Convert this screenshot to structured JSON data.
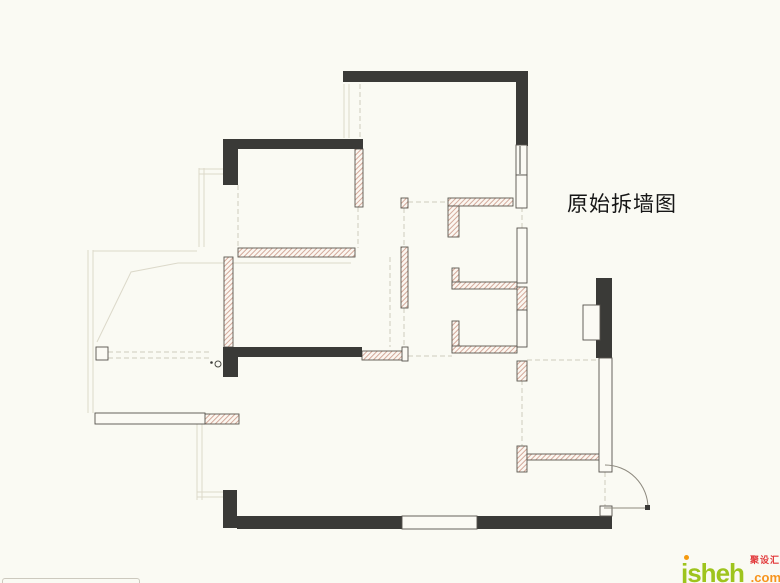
{
  "title": {
    "text": "原始拆墙图"
  },
  "watermark": {
    "brand": "jsheh",
    "tld": ".com",
    "cn": "聚设汇"
  },
  "colors": {
    "background": "#fafaf3",
    "structural_wall": "#3a3a37",
    "hatch_line": "#d4a99a",
    "wall_outline": "#55524c",
    "faint_line": "#dcd9ca",
    "brand_green": "#9ec41d",
    "brand_orange": "#f7941d",
    "brand_red": "#e23a3c"
  },
  "plan": {
    "black_walls": [
      [
        343,
        71,
        185,
        11
      ],
      [
        516,
        82,
        12,
        64
      ],
      [
        223,
        139,
        140,
        10
      ],
      [
        223,
        149,
        15,
        36
      ],
      [
        223,
        347,
        139,
        10
      ],
      [
        223,
        347,
        15,
        30
      ],
      [
        223,
        490,
        14,
        38
      ],
      [
        237,
        516,
        165,
        13
      ],
      [
        477,
        516,
        135,
        13
      ],
      [
        596,
        278,
        16,
        80
      ]
    ],
    "hatched_walls": [
      [
        355,
        149,
        8,
        58
      ],
      [
        238,
        248,
        117,
        9
      ],
      [
        224,
        257,
        9,
        90
      ],
      [
        401,
        198,
        7,
        10
      ],
      [
        401,
        247,
        7,
        61
      ],
      [
        448,
        198,
        65,
        8
      ],
      [
        448,
        206,
        11,
        31
      ],
      [
        452,
        268,
        7,
        21
      ],
      [
        452,
        282,
        65,
        7
      ],
      [
        452,
        321,
        7,
        31
      ],
      [
        452,
        346,
        65,
        7
      ],
      [
        517,
        287,
        10,
        24
      ],
      [
        517,
        361,
        10,
        20
      ],
      [
        517,
        446,
        10,
        26
      ],
      [
        527,
        454,
        73,
        6
      ],
      [
        204,
        414,
        35,
        10
      ],
      [
        362,
        351,
        41,
        9
      ]
    ],
    "white_walls": [
      [
        516,
        145,
        11,
        30
      ],
      [
        516,
        175,
        11,
        33
      ],
      [
        517,
        228,
        10,
        55
      ],
      [
        517,
        310,
        10,
        37
      ],
      [
        599,
        358,
        13,
        114
      ],
      [
        583,
        305,
        17,
        35
      ],
      [
        96,
        347,
        12,
        13
      ],
      [
        95,
        413,
        110,
        11
      ],
      [
        402,
        516,
        75,
        13
      ],
      [
        402,
        347,
        6,
        14
      ],
      [
        600,
        506,
        12,
        10
      ]
    ],
    "solid_faint_lines": [
      [
        88,
        250,
        88,
        413
      ],
      [
        93,
        250,
        93,
        413
      ],
      [
        93,
        251,
        197,
        251
      ],
      [
        344,
        84,
        344,
        138
      ],
      [
        349,
        84,
        349,
        138
      ],
      [
        199,
        168,
        199,
        247
      ],
      [
        204,
        168,
        204,
        247
      ],
      [
        199,
        169,
        223,
        169
      ],
      [
        199,
        174,
        223,
        174
      ],
      [
        197,
        424,
        197,
        500
      ],
      [
        202,
        424,
        202,
        500
      ],
      [
        197,
        492,
        223,
        492
      ],
      [
        197,
        497,
        223,
        497
      ]
    ],
    "dashed_lines": [
      [
        360,
        84,
        360,
        138
      ],
      [
        238,
        185,
        238,
        248
      ],
      [
        358,
        207,
        358,
        248
      ],
      [
        404,
        208,
        404,
        247
      ],
      [
        404,
        308,
        404,
        347
      ],
      [
        522,
        207,
        522,
        228
      ],
      [
        522,
        380,
        522,
        446
      ],
      [
        605,
        472,
        605,
        506
      ],
      [
        390,
        257,
        390,
        347
      ],
      [
        408,
        356,
        452,
        356
      ],
      [
        527,
        360,
        598,
        360
      ],
      [
        408,
        202,
        448,
        202
      ],
      [
        108,
        352,
        210,
        352
      ],
      [
        108,
        358,
        210,
        358
      ]
    ],
    "bay_polyline": "97,342 131,272 178,263 351,263",
    "marks": {
      "window_divider": [
        520,
        146,
        520,
        174
      ],
      "circle": [
        218,
        364,
        3
      ],
      "dot": [
        211.5,
        362.5,
        1.3
      ]
    },
    "door": {
      "leaf": [
        604,
        508,
        648,
        508
      ],
      "arc": "M 648 508 A 43 43 0 0 0 605 465",
      "hinge_dot": [
        645,
        505,
        5,
        5
      ]
    }
  }
}
